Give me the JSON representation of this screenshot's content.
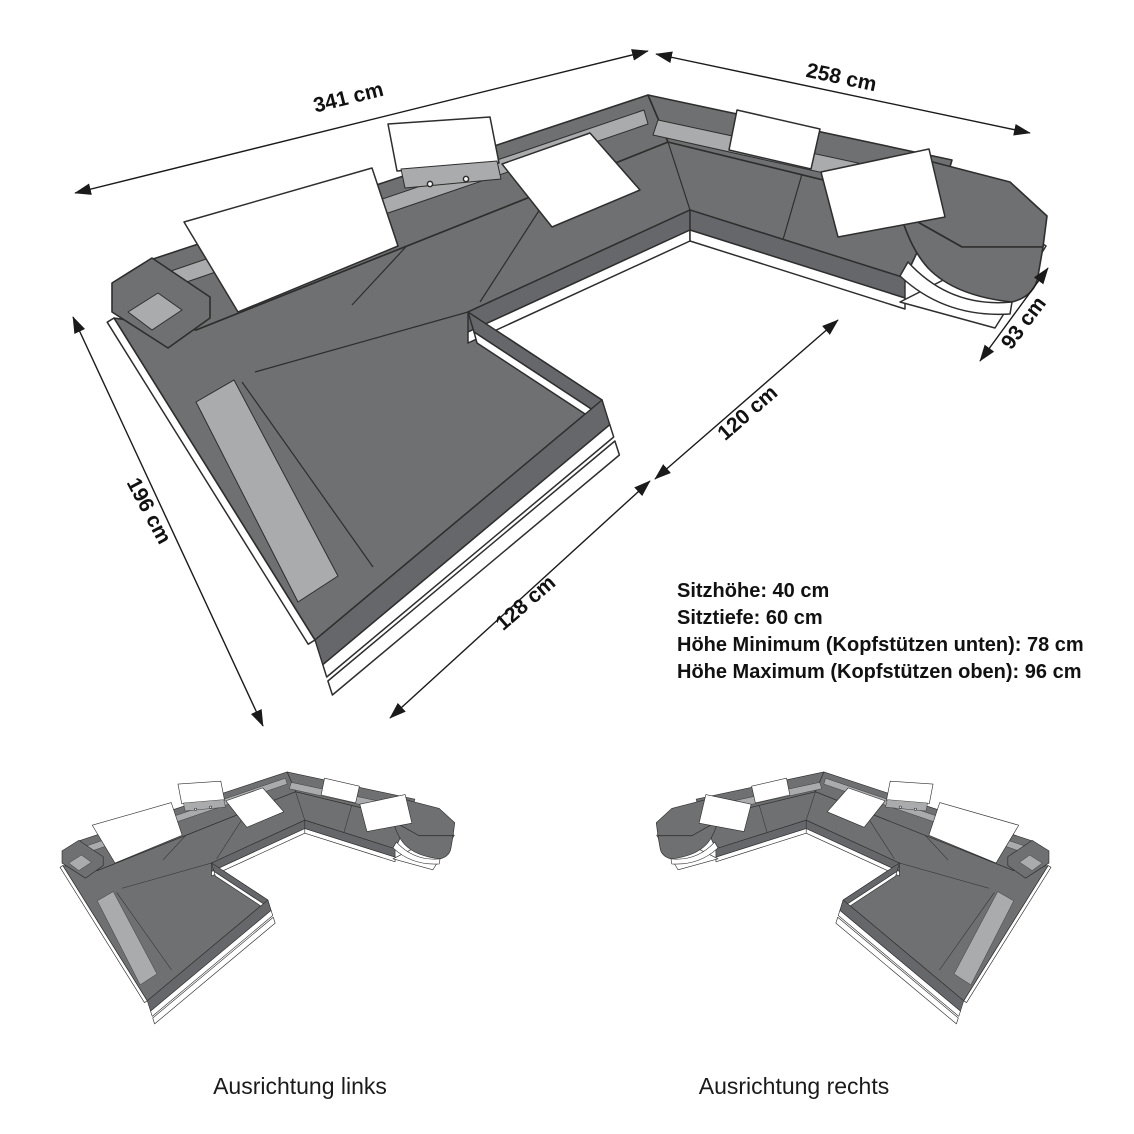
{
  "diagram": {
    "type": "furniture-dimension-drawing",
    "product": "U-shaped sectional sofa with adjustable headrests",
    "dimension_labels": {
      "back_width": "341 cm",
      "right_side_length": "258 cm",
      "right_end_depth": "93 cm",
      "inner_clearance": "120 cm",
      "left_side_depth": "196 cm",
      "chaise_front_width": "128 cm"
    },
    "specs": {
      "lines": [
        "Sitzhöhe: 40 cm",
        "Sitztiefe: 60 cm",
        "Höhe Minimum (Kopfstützen unten): 78 cm",
        "Höhe Maximum (Kopfstützen oben): 96 cm"
      ]
    },
    "variants": {
      "left_caption": "Ausrichtung links",
      "right_caption": "Ausrichtung rechts"
    },
    "colors": {
      "body_gray": "#6e7072",
      "side_gray": "#65676a",
      "led_gray": "#a9abad",
      "pillow_white": "#ffffff",
      "outline": "#2e2e2e",
      "text": "#111111"
    }
  }
}
